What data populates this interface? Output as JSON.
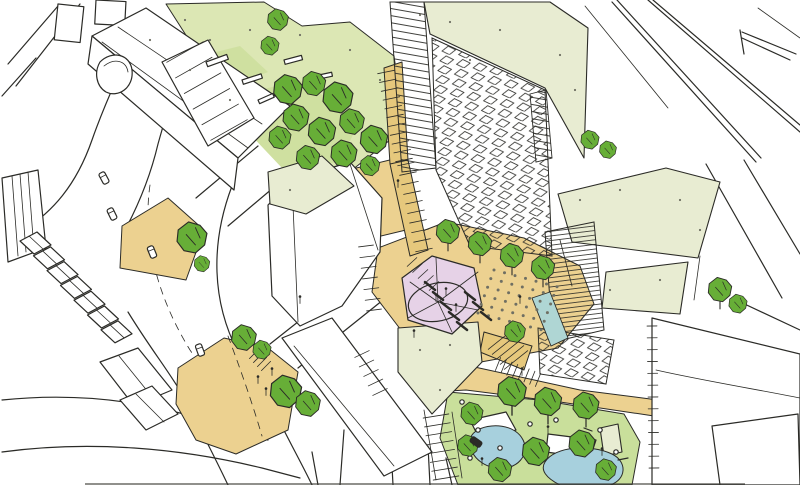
{
  "palette": {
    "paper": "#ffffff",
    "ink": "#2b2b27",
    "roof_pale": "#e8ecd2",
    "lawn_light": "#dce7b4",
    "lawn_mid": "#cfe0a0",
    "park_lawn": "#c9df9b",
    "tree": "#67ae37",
    "tan": "#ecd190",
    "tan_deep": "#e6c87c",
    "pink": "#e6d2e7",
    "water": "#a7d0dd",
    "teal": "#afd6d4",
    "speckle": "#6f6f63"
  },
  "scene": {
    "trees": [
      [
        288,
        90,
        1.1,
        0
      ],
      [
        314,
        84,
        0.9,
        0
      ],
      [
        338,
        98,
        1.15,
        0
      ],
      [
        296,
        118,
        1.0,
        0
      ],
      [
        322,
        132,
        1.05,
        0
      ],
      [
        352,
        122,
        0.95,
        0
      ],
      [
        374,
        140,
        1.05,
        0
      ],
      [
        344,
        154,
        1.0,
        0
      ],
      [
        308,
        158,
        0.9,
        0
      ],
      [
        280,
        138,
        0.85,
        0
      ],
      [
        370,
        166,
        0.75,
        0
      ],
      [
        278,
        20,
        0.8,
        0
      ],
      [
        270,
        46,
        0.7,
        0
      ],
      [
        192,
        238,
        1.15,
        0
      ],
      [
        202,
        264,
        0.6,
        0
      ],
      [
        244,
        338,
        0.95,
        0
      ],
      [
        262,
        350,
        0.7,
        0
      ],
      [
        286,
        392,
        1.2,
        0
      ],
      [
        308,
        404,
        0.95,
        0
      ],
      [
        448,
        232,
        0.9,
        1
      ],
      [
        480,
        244,
        0.9,
        1
      ],
      [
        512,
        256,
        0.9,
        1
      ],
      [
        543,
        268,
        0.9,
        1
      ],
      [
        720,
        290,
        0.9,
        1
      ],
      [
        738,
        304,
        0.7,
        0
      ],
      [
        590,
        140,
        0.7,
        0
      ],
      [
        608,
        150,
        0.65,
        0
      ],
      [
        515,
        332,
        0.8,
        0
      ],
      [
        512,
        392,
        1.1,
        1
      ],
      [
        548,
        402,
        1.05,
        1
      ],
      [
        586,
        406,
        1.0,
        1
      ],
      [
        582,
        444,
        1.0,
        0
      ],
      [
        536,
        452,
        1.05,
        0
      ],
      [
        500,
        470,
        0.9,
        0
      ],
      [
        606,
        470,
        0.8,
        0
      ],
      [
        472,
        414,
        0.85,
        0
      ],
      [
        468,
        446,
        0.8,
        0
      ]
    ],
    "cars": [
      [
        104,
        178,
        62,
        0
      ],
      [
        112,
        214,
        64,
        0
      ],
      [
        152,
        252,
        68,
        0
      ],
      [
        200,
        350,
        70,
        0
      ],
      [
        476,
        442,
        35,
        1
      ]
    ],
    "people": [
      [
        258,
        380
      ],
      [
        266,
        392
      ],
      [
        272,
        372
      ],
      [
        436,
        298
      ],
      [
        446,
        292
      ],
      [
        456,
        308
      ],
      [
        398,
        184
      ],
      [
        522,
        372
      ],
      [
        548,
        430
      ],
      [
        602,
        452
      ],
      [
        482,
        462
      ],
      [
        414,
        334
      ],
      [
        520,
        300
      ],
      [
        300,
        300
      ]
    ],
    "speckles": [
      [
        420,
        15
      ],
      [
        450,
        22
      ],
      [
        500,
        30
      ],
      [
        560,
        55
      ],
      [
        575,
        90
      ],
      [
        545,
        120
      ],
      [
        470,
        60
      ],
      [
        185,
        20
      ],
      [
        210,
        40
      ],
      [
        250,
        30
      ],
      [
        300,
        35
      ],
      [
        350,
        50
      ],
      [
        380,
        80
      ],
      [
        150,
        40
      ],
      [
        190,
        70
      ],
      [
        230,
        100
      ],
      [
        580,
        200
      ],
      [
        620,
        190
      ],
      [
        680,
        200
      ],
      [
        700,
        230
      ],
      [
        420,
        350
      ],
      [
        450,
        345
      ],
      [
        440,
        390
      ],
      [
        290,
        190
      ],
      [
        610,
        290
      ],
      [
        660,
        280
      ]
    ],
    "ladders": [
      {
        "x1": 386,
        "y1": 72,
        "x2": 404,
        "y2": 160,
        "w": 17,
        "n": 11
      },
      {
        "x1": 406,
        "y1": 164,
        "x2": 424,
        "y2": 250,
        "w": 17,
        "n": 10
      },
      {
        "x1": 185,
        "y1": 52,
        "x2": 229,
        "y2": 130,
        "w": 42,
        "n": 6
      },
      {
        "x1": 436,
        "y1": 416,
        "x2": 446,
        "y2": 478,
        "w": 26,
        "n": 8
      },
      {
        "x1": 652,
        "y1": 326,
        "x2": 654,
        "y2": 468,
        "w": 10,
        "n": 13
      },
      {
        "x1": 366,
        "y1": 246,
        "x2": 374,
        "y2": 310,
        "w": 15,
        "n": 7
      },
      {
        "x1": 412,
        "y1": 262,
        "x2": 434,
        "y2": 286,
        "w": 13,
        "n": 5
      },
      {
        "x1": 500,
        "y1": 340,
        "x2": 516,
        "y2": 360,
        "w": 30,
        "n": 5
      },
      {
        "x1": 498,
        "y1": 364,
        "x2": 538,
        "y2": 380,
        "w": 14,
        "n": 8
      },
      {
        "x1": 254,
        "y1": 354,
        "x2": 266,
        "y2": 366,
        "w": 13,
        "n": 4
      },
      {
        "x1": 362,
        "y1": 354,
        "x2": 380,
        "y2": 392,
        "w": 16,
        "n": 5
      }
    ],
    "terrace_row": {
      "x": 20,
      "y": 232,
      "dx": 13.5,
      "dy": 14.8,
      "n": 7
    },
    "plaza_dots": {
      "ox": 494,
      "oy": 270,
      "ux": 10.5,
      "uy": 2.8,
      "vx": -3.2,
      "vy": 8.6,
      "cols": 7,
      "rows": 6
    },
    "benches": {
      "angle": 38,
      "length": 13,
      "points": [
        [
          430,
          286
        ],
        [
          438,
          296
        ],
        [
          446,
          306
        ],
        [
          454,
          316
        ],
        [
          462,
          326
        ],
        [
          470,
          296
        ],
        [
          478,
          306
        ],
        [
          486,
          316
        ]
      ]
    },
    "pebbles": [
      [
        462,
        402
      ],
      [
        478,
        430
      ],
      [
        530,
        424
      ],
      [
        556,
        420
      ],
      [
        600,
        430
      ],
      [
        616,
        452
      ],
      [
        500,
        448
      ],
      [
        470,
        458
      ]
    ]
  }
}
